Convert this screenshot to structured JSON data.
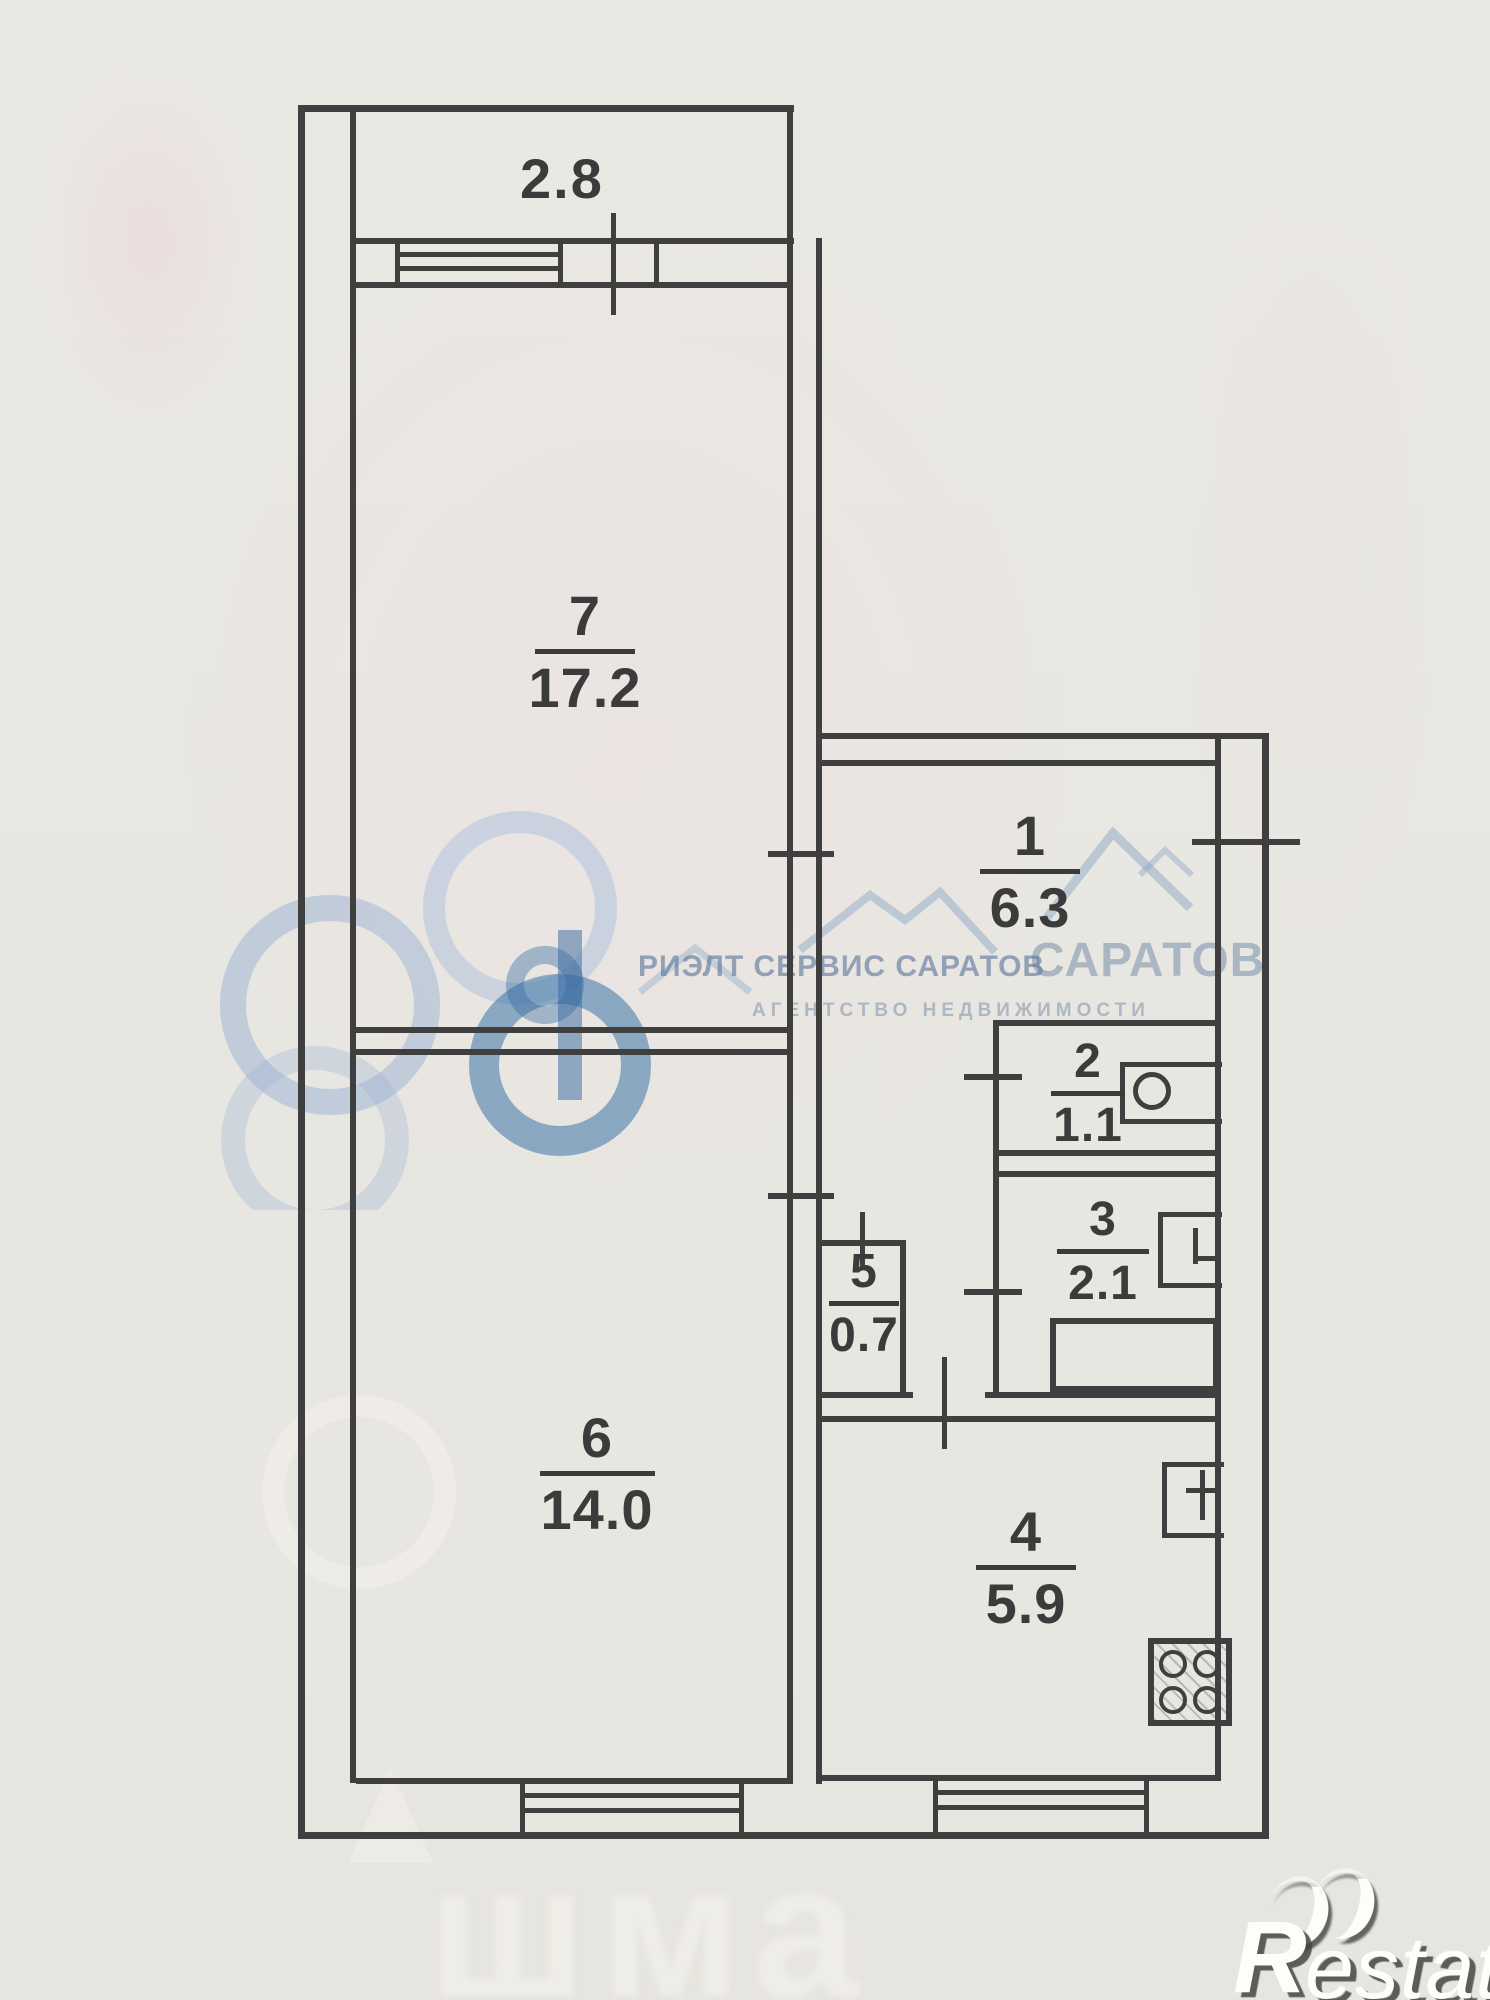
{
  "plan": {
    "balcony_width_label": "2.8",
    "rooms": {
      "r7": {
        "number": "7",
        "area": "17.2"
      },
      "r1": {
        "number": "1",
        "area": "6.3"
      },
      "r2": {
        "number": "2",
        "area": "1.1"
      },
      "r3": {
        "number": "3",
        "area": "2.1"
      },
      "r5": {
        "number": "5",
        "area": "0.7"
      },
      "r6": {
        "number": "6",
        "area": "14.0"
      },
      "r4": {
        "number": "4",
        "area": "5.9"
      }
    }
  },
  "watermarks": {
    "agency_name": "РИЭЛТ СЕРВИС САРАТОВ",
    "agency_name_echo": "САРАТОВ",
    "agency_tagline": "АГЕНТСТВО НЕДВИЖИМОСТИ",
    "ghost_text": "шма",
    "brand_initial": "R",
    "brand_rest": "estate"
  },
  "colors": {
    "paper": "#e9e7e2",
    "line": "#3f3f3f",
    "watermark_blue": "#4e7fae",
    "brand_white": "#fdfdfa"
  }
}
